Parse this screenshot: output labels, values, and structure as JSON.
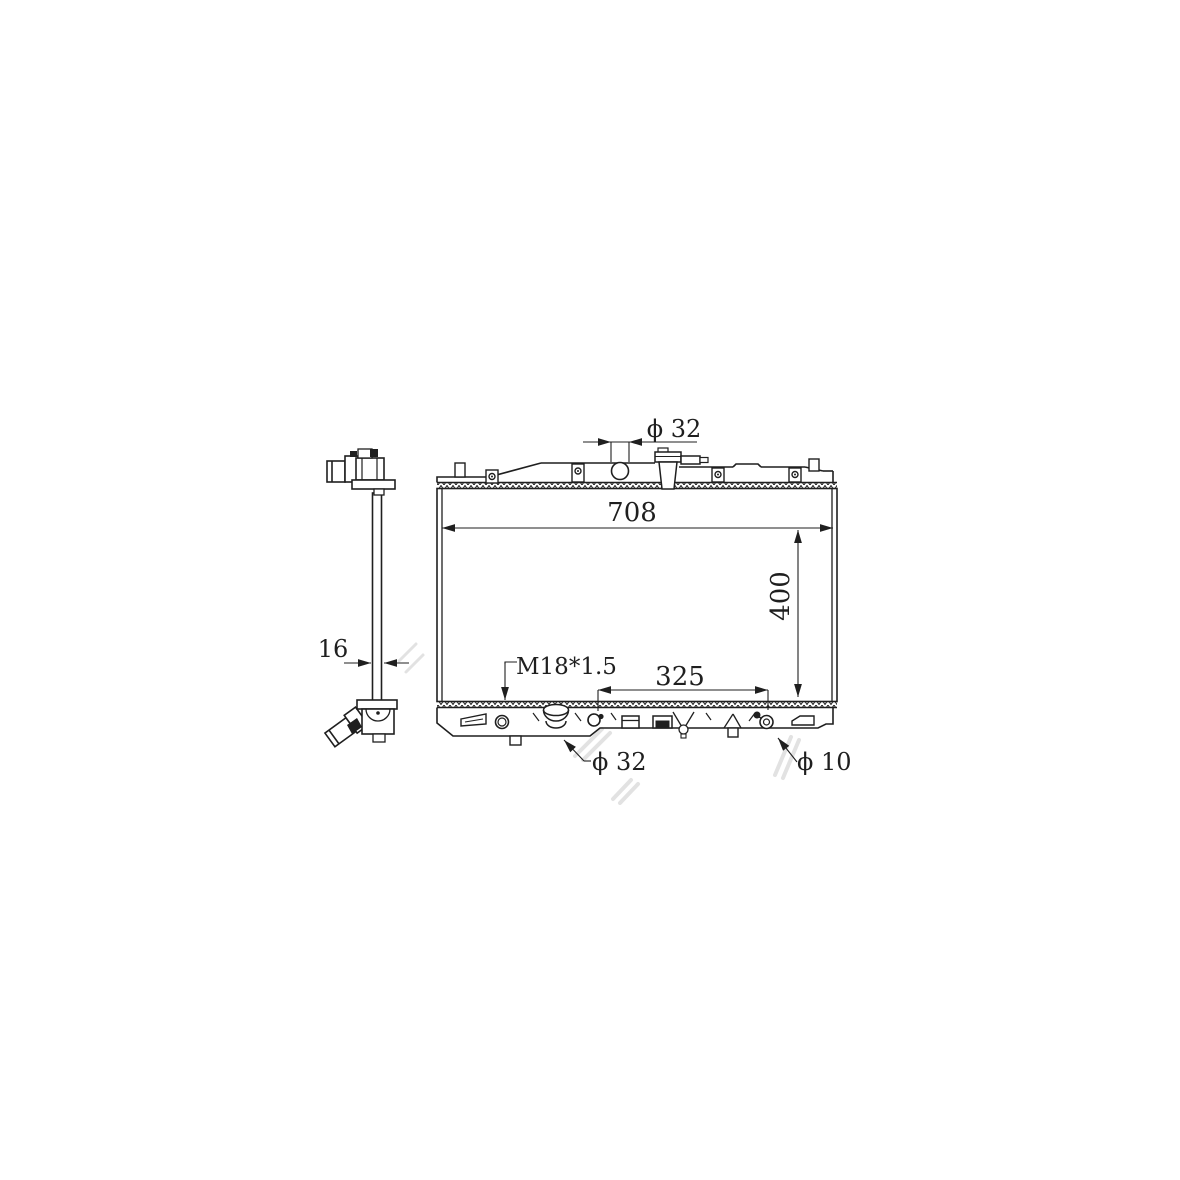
{
  "page": {
    "background": "#ffffff"
  },
  "drawing": {
    "subject": "radiator-technical-drawing",
    "watermark": "ALTAY",
    "line_color": "#1f1f1f",
    "watermark_color": "#cccccc",
    "labels": {
      "top_inlet_dia": "ϕ 32",
      "core_width": "708",
      "core_height": "400",
      "core_thickness": "16",
      "drain_thread": "M18*1.5",
      "lower_span": "325",
      "outlet_dia": "ϕ 32",
      "small_fitting_dia": "ϕ 10"
    }
  }
}
